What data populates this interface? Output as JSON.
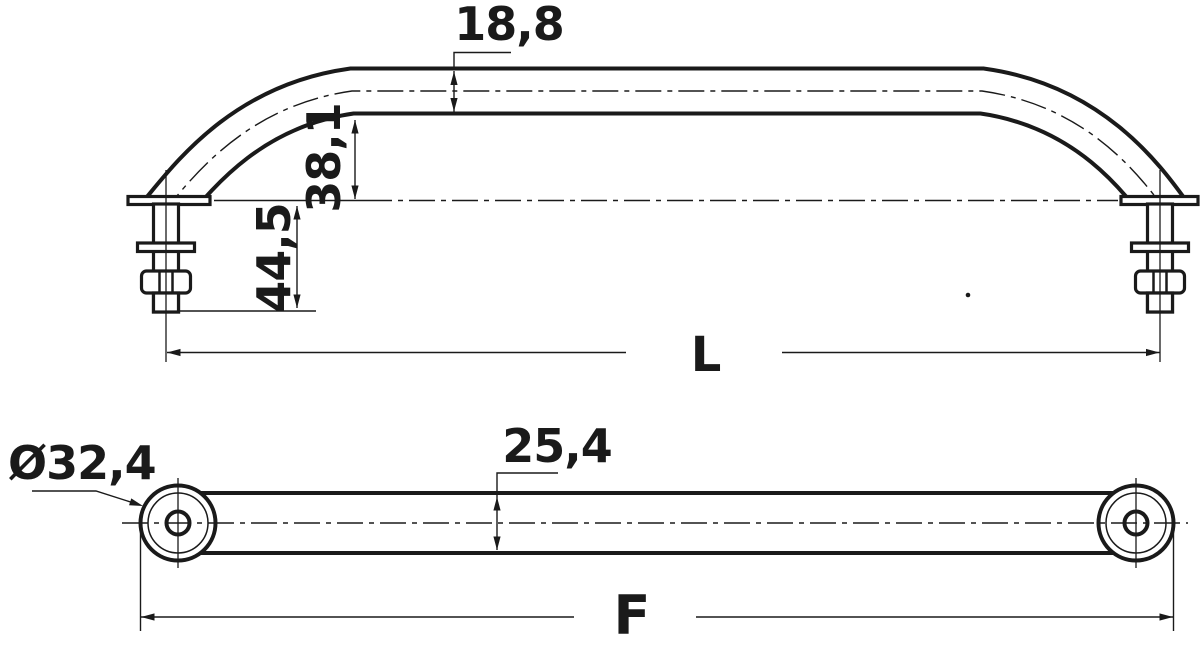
{
  "drawing_title": "Handrail technical drawing (side elevation and plan view)",
  "colors": {
    "background": "#ffffff",
    "line": "#1a1a1a"
  },
  "side_view": {
    "view_name": "side elevation with mounting studs",
    "dims": {
      "tube_section_height": "18,8",
      "underside_clearance": "38,1",
      "stud_length": "44,5",
      "overall_length": "L"
    }
  },
  "plan_view": {
    "view_name": "plan view of rail with end bases",
    "dims": {
      "end_base_diameter": "Ø32,4",
      "tube_width": "25,4",
      "fixing_centres": "F"
    }
  }
}
